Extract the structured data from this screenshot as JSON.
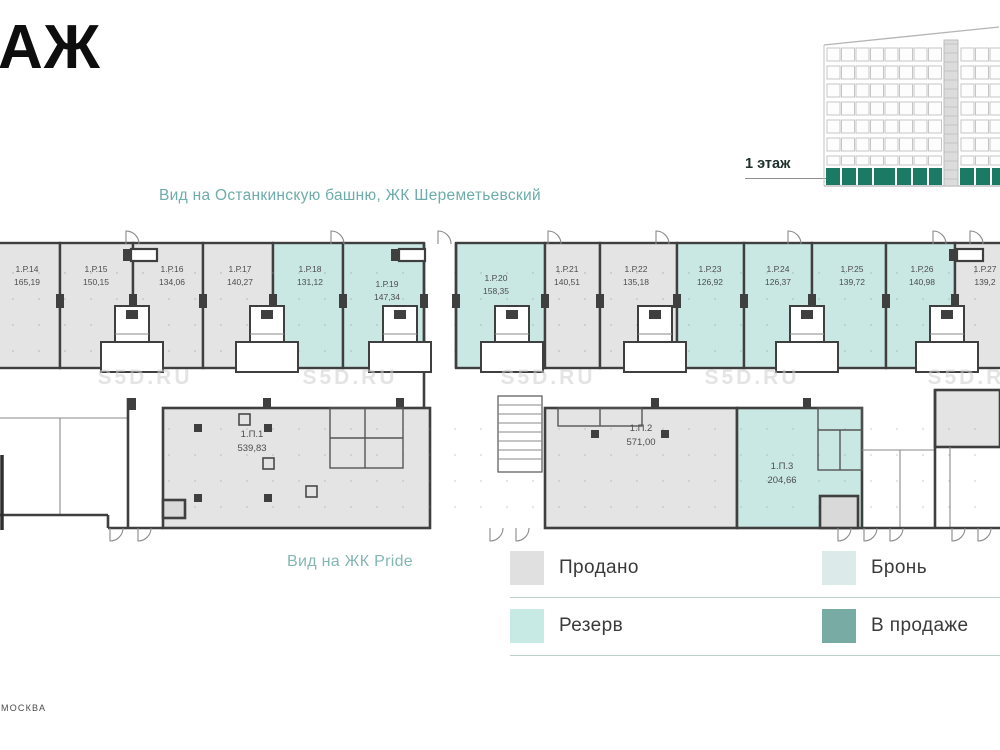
{
  "header": {
    "title": "АЖ"
  },
  "captions": {
    "top_view": "Вид на Останкинскую башню, ЖК Шереметьевский",
    "bottom_view": "Вид на ЖК Pride"
  },
  "building": {
    "floor_label": "1 этаж"
  },
  "watermark": {
    "text": "S5D.RU"
  },
  "footer": {
    "city": "МОСКВА"
  },
  "colors": {
    "sold": "#e4e4e4",
    "reserve": "#c9e8e4",
    "booking": "#dfeceb",
    "on_sale": "#77aba3",
    "building_floor": "#1b7a63",
    "wall": "#3f3f3f"
  },
  "legend": [
    {
      "id": "sold",
      "label": "Продано",
      "color": "#e0e0e0"
    },
    {
      "id": "reserve",
      "label": "Резерв",
      "color": "#c7eae5"
    },
    {
      "id": "booking",
      "label": "Бронь",
      "color": "#dcebe9"
    },
    {
      "id": "on_sale",
      "label": "В продаже",
      "color": "#77aba3"
    }
  ],
  "units": {
    "retail": [
      {
        "id": "1.Р.14",
        "area": "165,19",
        "status": "sold"
      },
      {
        "id": "1.Р.15",
        "area": "150,15",
        "status": "sold"
      },
      {
        "id": "1.Р.16",
        "area": "134,06",
        "status": "sold"
      },
      {
        "id": "1.Р.17",
        "area": "140,27",
        "status": "sold"
      },
      {
        "id": "1.Р.18",
        "area": "131,12",
        "status": "reserve"
      },
      {
        "id": "1.Р.19",
        "area": "147,34",
        "status": "reserve"
      },
      {
        "id": "1.Р.20",
        "area": "158,35",
        "status": "reserve"
      },
      {
        "id": "1.Р.21",
        "area": "140,51",
        "status": "sold"
      },
      {
        "id": "1.Р.22",
        "area": "135,18",
        "status": "sold"
      },
      {
        "id": "1.Р.23",
        "area": "126,92",
        "status": "reserve"
      },
      {
        "id": "1.Р.24",
        "area": "126,37",
        "status": "reserve"
      },
      {
        "id": "1.Р.25",
        "area": "139,72",
        "status": "reserve"
      },
      {
        "id": "1.Р.26",
        "area": "140,98",
        "status": "reserve"
      },
      {
        "id": "1.Р.27",
        "area": "139,2",
        "status": "sold"
      }
    ],
    "large": [
      {
        "id": "1.П.1",
        "area": "539,83",
        "status": "sold"
      },
      {
        "id": "1.П.2",
        "area": "571,00",
        "status": "sold"
      },
      {
        "id": "1.П.3",
        "area": "204,66",
        "status": "reserve"
      }
    ]
  }
}
